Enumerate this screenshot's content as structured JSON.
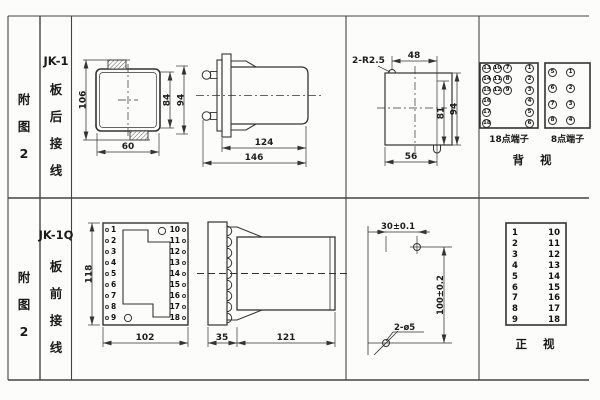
{
  "row1": {
    "fig": "附\n图\n2",
    "model": "JK-1",
    "wiring": "板\n后\n接\n线",
    "rear": {
      "height": "106",
      "inner": "84",
      "outer": "94",
      "width": "60"
    },
    "side": {
      "depth": "124",
      "total": "146"
    },
    "cutout": {
      "radius": "2-R2.5",
      "top": "48",
      "inner": "81",
      "outer": "94",
      "bottom": "56"
    },
    "term18": {
      "label": "18点端子",
      "values": [
        "13",
        "10",
        "7",
        "1",
        "14",
        "11",
        "8",
        "2",
        "15",
        "12",
        "9",
        "3",
        "16",
        "4",
        "17",
        "5",
        "18",
        "6"
      ]
    },
    "term8": {
      "label": "8点端子",
      "values": [
        "5",
        "1",
        "6",
        "2",
        "7",
        "3",
        "8",
        "4"
      ]
    },
    "view": "背 视"
  },
  "row2": {
    "fig": "附\n图\n2",
    "model": "JK-1Q",
    "wiring": "板\n前\n接\n线",
    "front": {
      "height": "118",
      "width": "102",
      "left": [
        "1",
        "2",
        "3",
        "4",
        "5",
        "6",
        "7",
        "8",
        "9"
      ],
      "right": [
        "10",
        "11",
        "12",
        "13",
        "14",
        "15",
        "16",
        "17",
        "18"
      ]
    },
    "side": {
      "plate": "35",
      "depth": "121"
    },
    "drill": {
      "width": "30±0.1",
      "height": "100±0.2",
      "holes": "2-ø5"
    },
    "table": {
      "left": [
        "1",
        "2",
        "3",
        "4",
        "5",
        "6",
        "7",
        "8",
        "9"
      ],
      "right": [
        "10",
        "11",
        "12",
        "13",
        "14",
        "15",
        "16",
        "17",
        "18"
      ]
    },
    "view": "正 视"
  }
}
